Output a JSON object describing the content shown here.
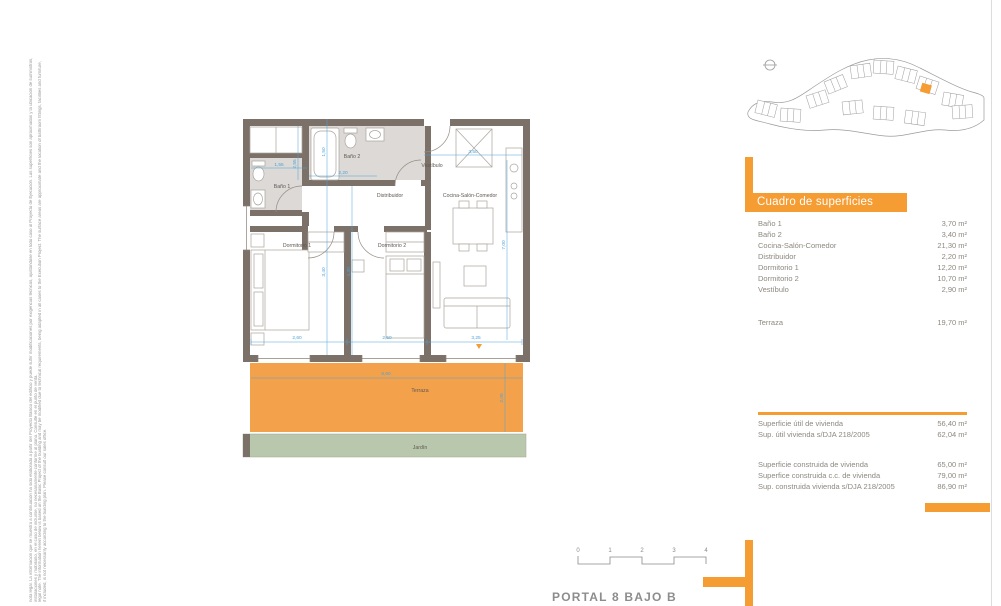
{
  "colors": {
    "accent_orange": "#F59C33",
    "wall": "#7B7168",
    "bath_floor": "#DCD9D6",
    "terrace_fill": "#F4A14C",
    "garden_fill": "#B9C8AD",
    "dimension_blue": "#4FA3D8",
    "table_text": "#8D8880"
  },
  "legal_note": {
    "line1_es": "nota legal. La información que se muestra a continuación ha sido elaborada a partir del Proyecto Básico del edificio y puede sufrir modificaciones por exigencias técnicas, ajustándose en todo caso al Proyecto de Ejecución. Las superficies son aproximadas y la ubicación de suministros,",
    "line2_es": "instalaciones y mobiliario, en el caso de incluirse, no necesariamente conforme al plano. Consulte en el punto de venta.",
    "line3_en": "legal note. The information herein below is based on the Basic Project of the building and may be modified due to technical requirements, being adapted in all cases to the Execution Project. The surface areas are approximate and the location of bathroom fittings, facilities and furniture,",
    "line4_en": "if included, is not necessarily according to the building plan. Please consult our sales office."
  },
  "plan": {
    "rooms": [
      {
        "label": "Baño 1"
      },
      {
        "label": "Baño 2"
      },
      {
        "label": "Vestíbulo"
      },
      {
        "label": "Distribuidor"
      },
      {
        "label": "Cocina-Salón-Comedor"
      },
      {
        "label": "Dormitorio 1"
      },
      {
        "label": "Dormitorio 2"
      },
      {
        "label": "Terraza"
      },
      {
        "label": "Jardín"
      }
    ],
    "dimensions": [
      {
        "value": "1,55"
      },
      {
        "value": "2,55"
      },
      {
        "value": "1,50"
      },
      {
        "value": "2,20"
      },
      {
        "value": "3,50"
      },
      {
        "value": "7,00"
      },
      {
        "value": "3,40"
      },
      {
        "value": "4,30"
      },
      {
        "value": "2,60"
      },
      {
        "value": "2,50"
      },
      {
        "value": "3,25"
      },
      {
        "value": "8,60"
      },
      {
        "value": "2,05"
      }
    ]
  },
  "surfaces": {
    "title": "Cuadro de superficies",
    "rows": [
      {
        "label": "Baño 1",
        "value": "3,70 m²"
      },
      {
        "label": "Baño 2",
        "value": "3,40 m²"
      },
      {
        "label": "Cocina-Salón-Comedor",
        "value": "21,30 m²"
      },
      {
        "label": "Distribuidor",
        "value": "2,20 m²"
      },
      {
        "label": "Dormitorio 1",
        "value": "12,20 m²"
      },
      {
        "label": "Dormitorio 2",
        "value": "10,70 m²"
      },
      {
        "label": "Vestíbulo",
        "value": "2,90 m²"
      }
    ],
    "terrace": {
      "label": "Terraza",
      "value": "19,70 m²"
    },
    "useful": [
      {
        "label": "Superficie útil de vivienda",
        "value": "56,40 m²"
      },
      {
        "label": "Sup. útil vivienda s/DJA 218/2005",
        "value": "62,04 m²"
      }
    ],
    "built": [
      {
        "label": "Superficie construida de vivienda",
        "value": "65,00 m²"
      },
      {
        "label": "Superfice construida c.c. de vivienda",
        "value": "79,00 m²"
      },
      {
        "label": "Sup. construida vivienda s/DJA 218/2005",
        "value": "86,90 m²"
      }
    ]
  },
  "scalebar": {
    "ticks": [
      "0",
      "1",
      "2",
      "3",
      "4"
    ]
  },
  "footer": {
    "plan_title": "PORTAL 8 BAJO B"
  }
}
